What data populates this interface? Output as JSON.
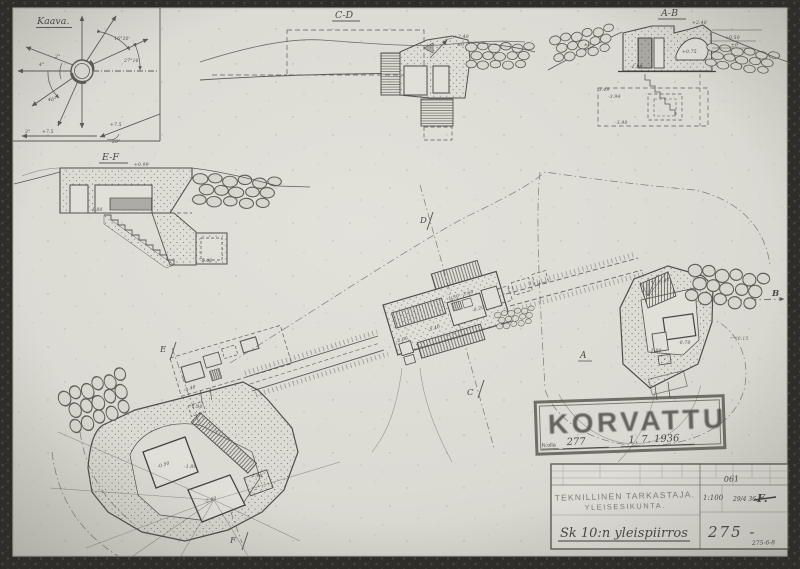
{
  "colors": {
    "paper": "#dbdad3",
    "paper_light": "#e1e0d9",
    "pencil": "#5c5b55",
    "pencil_faint": "#8a887e",
    "ink_dark": "#3f3e39",
    "stamp": "#55524b",
    "frame": "#2b2a27"
  },
  "compass": {
    "title": "Kaava.",
    "angle_ne": "16°20'",
    "angle_e": "27°16'",
    "angle_w1": "4°",
    "angle_w2": "2°",
    "angle_sw": "46°",
    "bottom_deg": "3°",
    "bottom_elev": "+7.5",
    "diag_elev": "+7.5",
    "diag_deg": "20°"
  },
  "sections": {
    "cd": {
      "title": "C-D",
      "elev_top": "+2.40",
      "elev_zero": "±0"
    },
    "ab": {
      "title": "A-B",
      "elev_top": "+2.40",
      "elev_mid": "+0.50",
      "elev_zero": "±0",
      "elev_zero_left": "±0",
      "elev_embrasure": "+0.75",
      "elev_floor": "-1.80",
      "elev_b1": "-3.49",
      "elev_b2": "-3.94",
      "elev_b3": "-3.90"
    },
    "ef": {
      "title": "E-F",
      "elev_top": "+0.99",
      "elev_floor": "-1.80",
      "elev_pit": "-5.00"
    }
  },
  "plan": {
    "marker_a": "A",
    "marker_b": "B",
    "marker_c": "C",
    "marker_d": "D",
    "marker_e": "E",
    "marker_f": "F",
    "trench_left_elev": "-5.40",
    "central": {
      "elev_main": "-5.40",
      "elev_right": "-0.20",
      "elev_r1": "-1.30",
      "elev_r2": "-3.60",
      "elev_side": "-2.00"
    },
    "right": {
      "elev_stair": "-5.40",
      "elev_room1": "-1.80",
      "elev_room2": "-0.70",
      "elev_outside": "-0.15"
    },
    "fort": {
      "elev_room1": "-0.50",
      "elev_room2": "-2.00",
      "elev_mid": "-1.80",
      "elev_stair": "-1.40",
      "elev_entry": "-1.00"
    }
  },
  "stamp": {
    "word": "KORVATTU",
    "no_label": "N:olla",
    "number": "277",
    "date": "1. 7. 1936"
  },
  "titleblock": {
    "org_line1": "TEKNILLINEN TARKASTAJA.",
    "org_line2": "YLEISESIKUNTA.",
    "title": "Sk 10:n yleispiirros",
    "scale": "1:100",
    "code": "061",
    "date": "29/4 36.",
    "signature": "F.",
    "number": "275 -",
    "corner_note": "275-6-8"
  }
}
